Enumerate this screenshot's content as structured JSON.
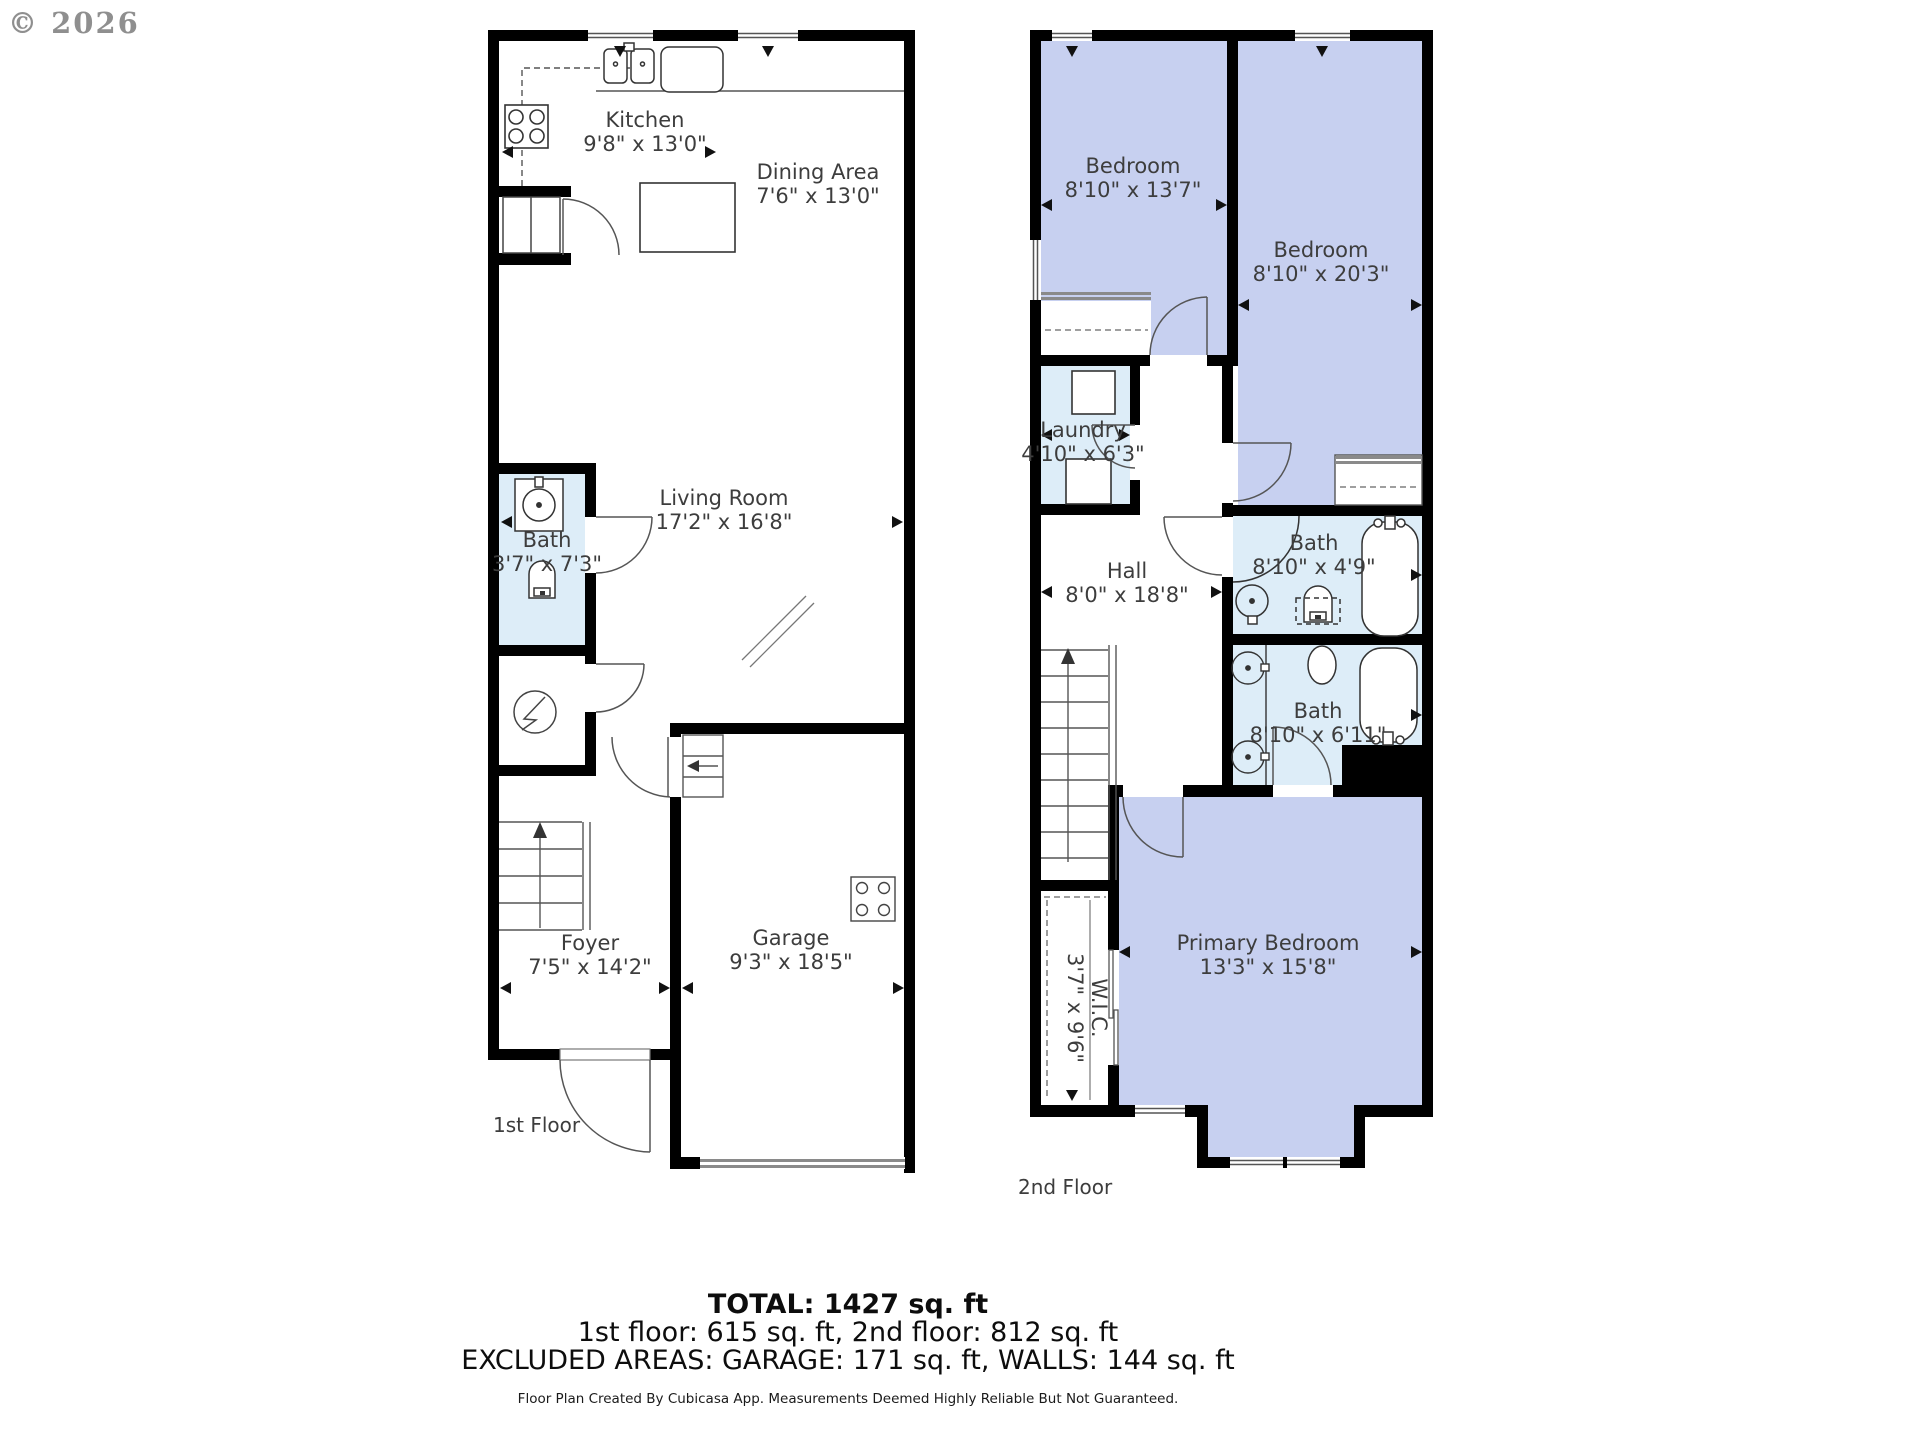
{
  "watermark": "© 2026",
  "colors": {
    "wall": "#000000",
    "bath_fill": "#ddedf8",
    "bedroom_fill": "#c7d0f0",
    "label_text": "#3d3d3d"
  },
  "floor1": {
    "label": "1st Floor",
    "rooms": {
      "kitchen": {
        "name": "Kitchen",
        "dims": "9'8\" x 13'0\""
      },
      "dining": {
        "name": "Dining Area",
        "dims": "7'6\" x 13'0\""
      },
      "living": {
        "name": "Living Room",
        "dims": "17'2\" x 16'8\""
      },
      "bath": {
        "name": "Bath",
        "dims": "3'7\" x 7'3\""
      },
      "foyer": {
        "name": "Foyer",
        "dims": "7'5\" x 14'2\""
      },
      "garage": {
        "name": "Garage",
        "dims": "9'3\" x 18'5\""
      }
    }
  },
  "floor2": {
    "label": "2nd Floor",
    "rooms": {
      "bedroom1": {
        "name": "Bedroom",
        "dims": "8'10\" x 13'7\""
      },
      "bedroom2": {
        "name": "Bedroom",
        "dims": "8'10\" x 20'3\""
      },
      "laundry": {
        "name": "Laundry",
        "dims": "4'10\" x 6'3\""
      },
      "hall": {
        "name": "Hall",
        "dims": "8'0\" x 18'8\""
      },
      "bath1": {
        "name": "Bath",
        "dims": "8'10\" x 4'9\""
      },
      "bath2": {
        "name": "Bath",
        "dims": "8'10\" x 6'11\""
      },
      "primary": {
        "name": "Primary Bedroom",
        "dims": "13'3\" x 15'8\""
      },
      "wic": {
        "name": "W.I.C.",
        "dims": "3'7\" x 9'6\""
      }
    }
  },
  "summary": {
    "total": "TOTAL: 1427 sq. ft",
    "floors": "1st floor: 615 sq. ft, 2nd floor: 812 sq. ft",
    "excluded": "EXCLUDED AREAS: GARAGE: 171 sq. ft, WALLS: 144 sq. ft",
    "disclaimer": "Floor Plan Created By Cubicasa App. Measurements Deemed Highly Reliable But Not Guaranteed."
  }
}
